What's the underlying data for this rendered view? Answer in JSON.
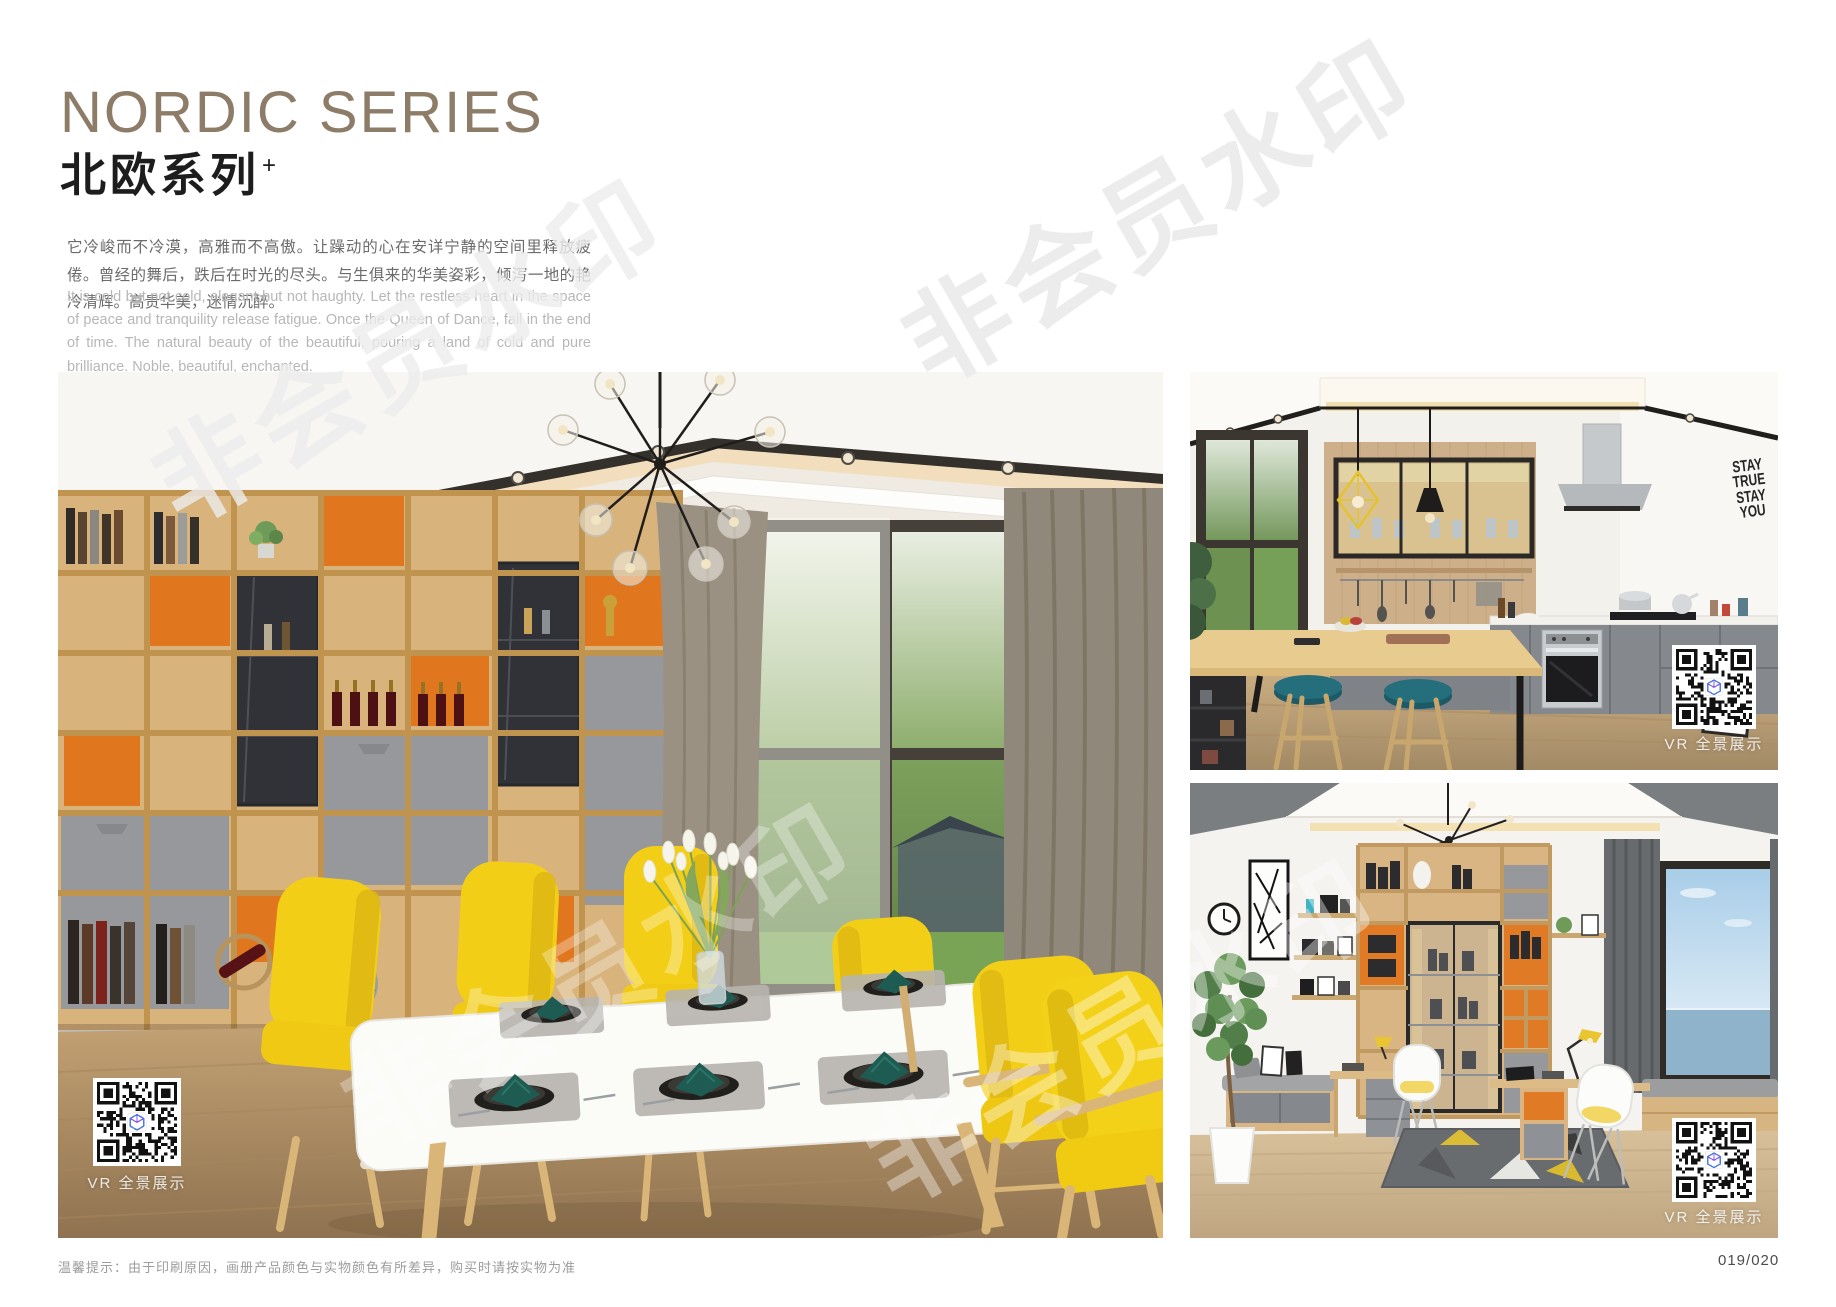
{
  "header": {
    "title_en": "NORDIC SERIES",
    "title_zh": "北欧系列",
    "title_sup": "+",
    "desc_zh": "它冷峻而不冷漠，高雅而不高傲。让躁动的心在安详宁静的空间里释放疲倦。曾经的舞后，跌后在时光的尽头。与生俱来的华美姿彩，倾泻一地的艳冷清辉。高贵华美，迷情沉醉。",
    "desc_en": "It is cold but not cold, elegant but not haughty. Let the restless heart in the space of peace and tranquility release fatigue. Once the Queen of Dance, fall in the end of time. The natural beauty of the beautiful, pouring a land of cold and pure brilliance. Noble, beautiful, enchanted."
  },
  "watermark": {
    "text": "非会员水印"
  },
  "photos": {
    "dining": {
      "vr_label": "VR 全景展示"
    },
    "kitchen": {
      "vr_label": "VR 全景展示",
      "wall_text": [
        "STAY",
        "TRUE",
        "STAY",
        "YOU"
      ]
    },
    "study": {
      "vr_label": "VR 全景展示"
    }
  },
  "footer": {
    "tip": "温馨提示：由于印刷原因，画册产品颜色与实物颜色有所差异，购买时请按实物为准",
    "page_number": "019/020"
  },
  "colors": {
    "title_taupe": "#8d7c68",
    "accent_orange": "#e0771f",
    "chair_yellow": "#f3ce17",
    "stool_teal": "#256e7b",
    "napkin_teal": "#1e5b52"
  }
}
